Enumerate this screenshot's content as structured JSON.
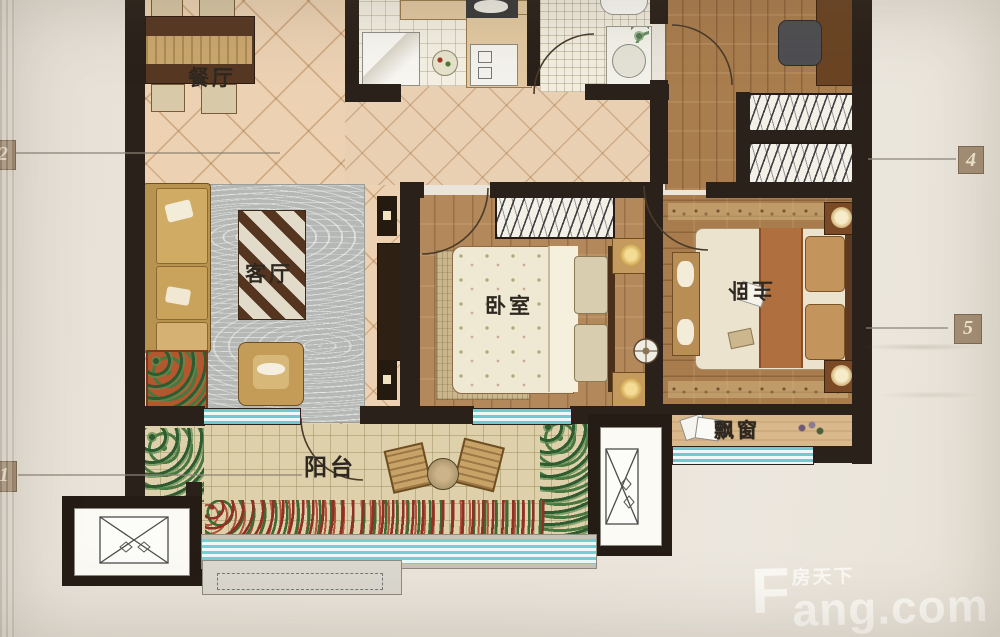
{
  "rooms": {
    "dining": {
      "label": "餐厅"
    },
    "living": {
      "label": "客厅"
    },
    "bedroom": {
      "label": "卧室"
    },
    "master": {
      "label": "主卧"
    },
    "balcony": {
      "label": "阳台"
    },
    "bay_window": {
      "label": "飘窗"
    }
  },
  "callouts": {
    "left_top": "2",
    "left_bottom": "1",
    "right_top": "4",
    "right_middle": "5"
  },
  "watermark": {
    "logo_letter": "F",
    "brand_cn": "房天下",
    "brand_rest": "ang.com"
  },
  "colors": {
    "wall": "#2a211a",
    "window_teal": "#74c9cf",
    "floor_tile": "#ecd2b3",
    "wood": "#a97d4e",
    "paper": "#e9e3d9",
    "rug_gray": "#b5b8b4",
    "watermark_white": "#fcfaf4"
  }
}
